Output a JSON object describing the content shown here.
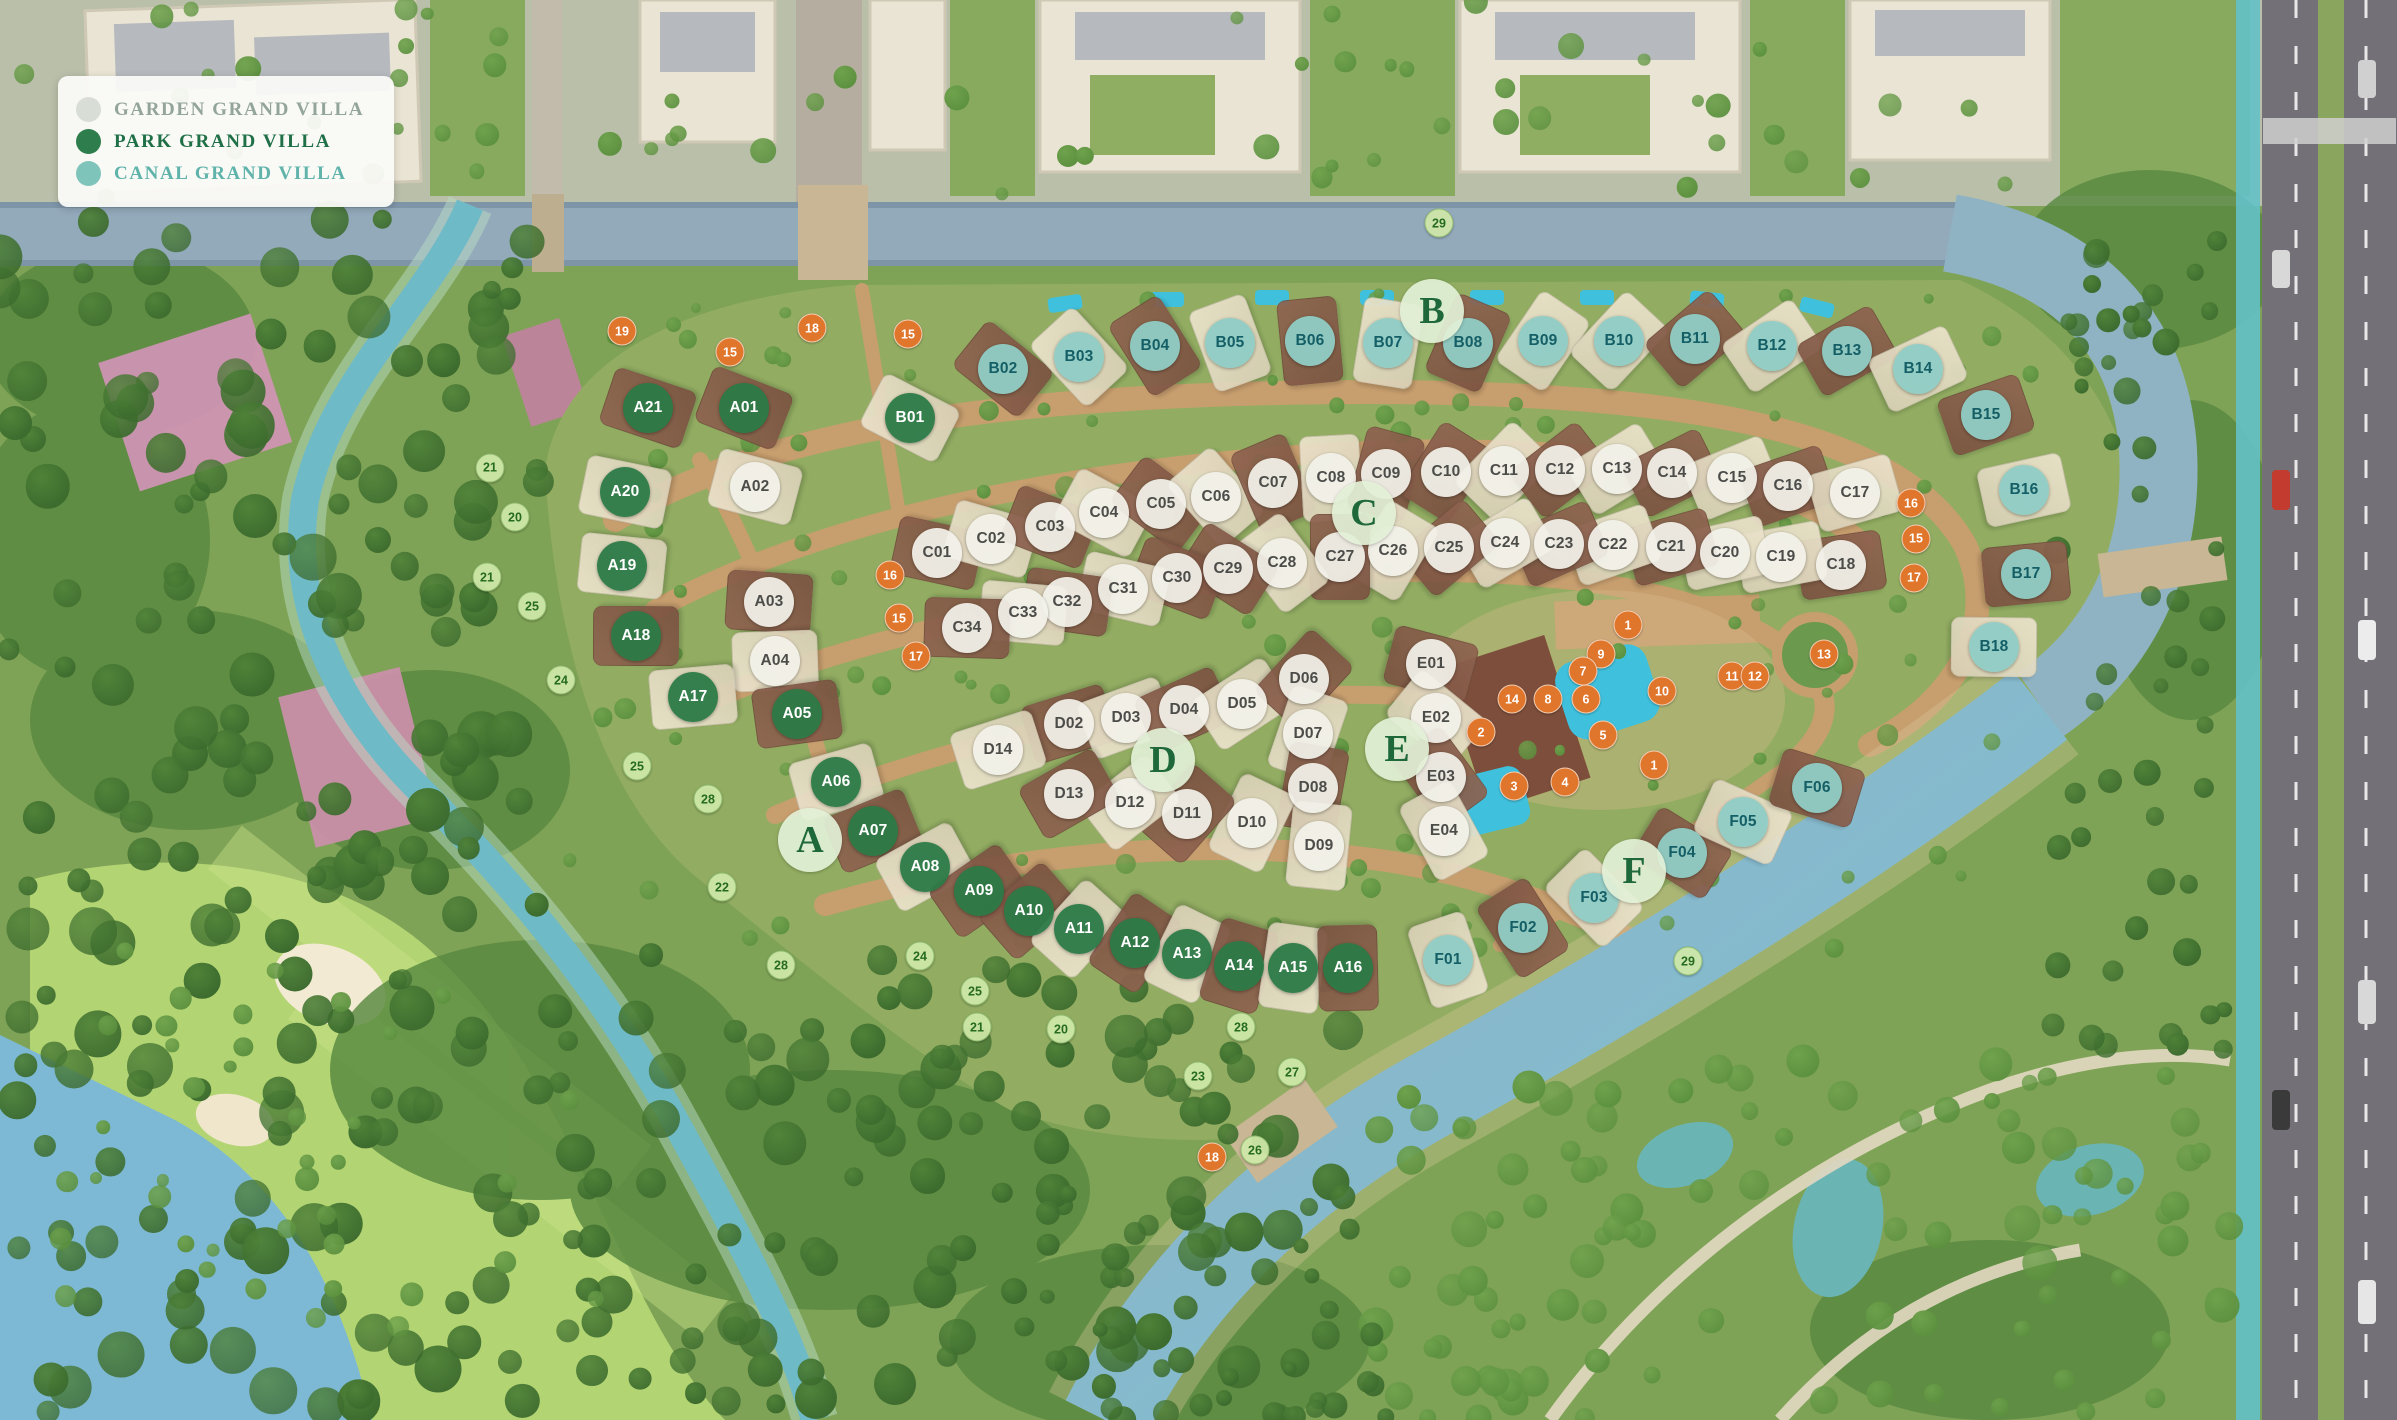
{
  "map_title": "Villa masterplan aerial map",
  "legend": {
    "items": [
      {
        "label": "GARDEN GRAND VILLA",
        "type": "garden",
        "dot_color": "#d8ddd6",
        "text_color": "#93a49b"
      },
      {
        "label": "PARK GRAND VILLA",
        "type": "park",
        "dot_color": "#2e7d4c",
        "text_color": "#1f6f47"
      },
      {
        "label": "CANAL GRAND VILLA",
        "type": "canal",
        "dot_color": "#7fc4bb",
        "text_color": "#5fb3aa"
      }
    ]
  },
  "colors": {
    "garden_badge": "#f2f1ea",
    "garden_text": "#4c4c49",
    "park_badge": "#2b7a47",
    "park_text": "#ffffff",
    "canal_badge": "#8fccc5",
    "canal_text": "#145e66",
    "green_marker": "#cfe8a8",
    "green_marker_text": "#266b1f",
    "orange_marker": "#e0762c",
    "orange_marker_text": "#ffffff",
    "water_top": "#93aabb",
    "water_canal": "#7cc0d8",
    "water_river": "#6fbac7",
    "golf": "#b3d473",
    "base_green": "#7fa356",
    "road_sand": "#c79e6e"
  },
  "sections": [
    {
      "id": "A",
      "x": 810,
      "y": 840
    },
    {
      "id": "B",
      "x": 1432,
      "y": 311
    },
    {
      "id": "C",
      "x": 1364,
      "y": 513
    },
    {
      "id": "D",
      "x": 1163,
      "y": 760
    },
    {
      "id": "E",
      "x": 1397,
      "y": 749
    },
    {
      "id": "F",
      "x": 1634,
      "y": 871
    }
  ],
  "villas": [
    {
      "id": "A01",
      "type": "park",
      "x": 744,
      "y": 408
    },
    {
      "id": "A02",
      "type": "garden",
      "x": 755,
      "y": 487
    },
    {
      "id": "A03",
      "type": "garden",
      "x": 769,
      "y": 602
    },
    {
      "id": "A04",
      "type": "garden",
      "x": 775,
      "y": 661
    },
    {
      "id": "A05",
      "type": "park",
      "x": 797,
      "y": 714
    },
    {
      "id": "A06",
      "type": "park",
      "x": 836,
      "y": 782
    },
    {
      "id": "A07",
      "type": "park",
      "x": 873,
      "y": 831
    },
    {
      "id": "A08",
      "type": "park",
      "x": 925,
      "y": 867
    },
    {
      "id": "A09",
      "type": "park",
      "x": 979,
      "y": 891
    },
    {
      "id": "A10",
      "type": "park",
      "x": 1029,
      "y": 911
    },
    {
      "id": "A11",
      "type": "park",
      "x": 1079,
      "y": 929
    },
    {
      "id": "A12",
      "type": "park",
      "x": 1135,
      "y": 943
    },
    {
      "id": "A13",
      "type": "park",
      "x": 1187,
      "y": 954
    },
    {
      "id": "A14",
      "type": "park",
      "x": 1239,
      "y": 966
    },
    {
      "id": "A15",
      "type": "park",
      "x": 1293,
      "y": 968
    },
    {
      "id": "A16",
      "type": "park",
      "x": 1348,
      "y": 968
    },
    {
      "id": "A17",
      "type": "park",
      "x": 693,
      "y": 697
    },
    {
      "id": "A18",
      "type": "park",
      "x": 636,
      "y": 636
    },
    {
      "id": "A19",
      "type": "park",
      "x": 622,
      "y": 566
    },
    {
      "id": "A20",
      "type": "park",
      "x": 625,
      "y": 492
    },
    {
      "id": "A21",
      "type": "park",
      "x": 648,
      "y": 408
    },
    {
      "id": "B01",
      "type": "park",
      "x": 910,
      "y": 418
    },
    {
      "id": "B02",
      "type": "canal",
      "x": 1003,
      "y": 369
    },
    {
      "id": "B03",
      "type": "canal",
      "x": 1079,
      "y": 357
    },
    {
      "id": "B04",
      "type": "canal",
      "x": 1155,
      "y": 346
    },
    {
      "id": "B05",
      "type": "canal",
      "x": 1230,
      "y": 343
    },
    {
      "id": "B06",
      "type": "canal",
      "x": 1310,
      "y": 341
    },
    {
      "id": "B07",
      "type": "canal",
      "x": 1388,
      "y": 343
    },
    {
      "id": "B08",
      "type": "canal",
      "x": 1468,
      "y": 343
    },
    {
      "id": "B09",
      "type": "canal",
      "x": 1543,
      "y": 341
    },
    {
      "id": "B10",
      "type": "canal",
      "x": 1619,
      "y": 341
    },
    {
      "id": "B11",
      "type": "canal",
      "x": 1695,
      "y": 339
    },
    {
      "id": "B12",
      "type": "canal",
      "x": 1772,
      "y": 346
    },
    {
      "id": "B13",
      "type": "canal",
      "x": 1847,
      "y": 351
    },
    {
      "id": "B14",
      "type": "canal",
      "x": 1918,
      "y": 369
    },
    {
      "id": "B15",
      "type": "canal",
      "x": 1986,
      "y": 415
    },
    {
      "id": "B16",
      "type": "canal",
      "x": 2024,
      "y": 490
    },
    {
      "id": "B17",
      "type": "canal",
      "x": 2026,
      "y": 574
    },
    {
      "id": "B18",
      "type": "canal",
      "x": 1994,
      "y": 647
    },
    {
      "id": "C01",
      "type": "garden",
      "x": 937,
      "y": 553
    },
    {
      "id": "C02",
      "type": "garden",
      "x": 991,
      "y": 539
    },
    {
      "id": "C03",
      "type": "garden",
      "x": 1050,
      "y": 527
    },
    {
      "id": "C04",
      "type": "garden",
      "x": 1104,
      "y": 513
    },
    {
      "id": "C05",
      "type": "garden",
      "x": 1161,
      "y": 504
    },
    {
      "id": "C06",
      "type": "garden",
      "x": 1216,
      "y": 497
    },
    {
      "id": "C07",
      "type": "garden",
      "x": 1273,
      "y": 483
    },
    {
      "id": "C08",
      "type": "garden",
      "x": 1331,
      "y": 478
    },
    {
      "id": "C09",
      "type": "garden",
      "x": 1386,
      "y": 474
    },
    {
      "id": "C10",
      "type": "garden",
      "x": 1446,
      "y": 472
    },
    {
      "id": "C11",
      "type": "garden",
      "x": 1504,
      "y": 471
    },
    {
      "id": "C12",
      "type": "garden",
      "x": 1560,
      "y": 470
    },
    {
      "id": "C13",
      "type": "garden",
      "x": 1617,
      "y": 469
    },
    {
      "id": "C14",
      "type": "garden",
      "x": 1672,
      "y": 473
    },
    {
      "id": "C15",
      "type": "garden",
      "x": 1732,
      "y": 478
    },
    {
      "id": "C16",
      "type": "garden",
      "x": 1788,
      "y": 486
    },
    {
      "id": "C17",
      "type": "garden",
      "x": 1855,
      "y": 493
    },
    {
      "id": "C18",
      "type": "garden",
      "x": 1841,
      "y": 565
    },
    {
      "id": "C19",
      "type": "garden",
      "x": 1781,
      "y": 557
    },
    {
      "id": "C20",
      "type": "garden",
      "x": 1725,
      "y": 553
    },
    {
      "id": "C21",
      "type": "garden",
      "x": 1671,
      "y": 547
    },
    {
      "id": "C22",
      "type": "garden",
      "x": 1613,
      "y": 545
    },
    {
      "id": "C23",
      "type": "garden",
      "x": 1559,
      "y": 544
    },
    {
      "id": "C24",
      "type": "garden",
      "x": 1505,
      "y": 543
    },
    {
      "id": "C25",
      "type": "garden",
      "x": 1449,
      "y": 548
    },
    {
      "id": "C26",
      "type": "garden",
      "x": 1393,
      "y": 551
    },
    {
      "id": "C27",
      "type": "garden",
      "x": 1340,
      "y": 557
    },
    {
      "id": "C28",
      "type": "garden",
      "x": 1282,
      "y": 563
    },
    {
      "id": "C29",
      "type": "garden",
      "x": 1228,
      "y": 569
    },
    {
      "id": "C30",
      "type": "garden",
      "x": 1177,
      "y": 578
    },
    {
      "id": "C31",
      "type": "garden",
      "x": 1123,
      "y": 589
    },
    {
      "id": "C32",
      "type": "garden",
      "x": 1067,
      "y": 602
    },
    {
      "id": "C33",
      "type": "garden",
      "x": 1023,
      "y": 613
    },
    {
      "id": "C34",
      "type": "garden",
      "x": 967,
      "y": 628
    },
    {
      "id": "D02",
      "type": "garden",
      "x": 1069,
      "y": 724
    },
    {
      "id": "D03",
      "type": "garden",
      "x": 1126,
      "y": 718
    },
    {
      "id": "D04",
      "type": "garden",
      "x": 1184,
      "y": 710
    },
    {
      "id": "D05",
      "type": "garden",
      "x": 1242,
      "y": 704
    },
    {
      "id": "D06",
      "type": "garden",
      "x": 1304,
      "y": 679
    },
    {
      "id": "D07",
      "type": "garden",
      "x": 1308,
      "y": 734
    },
    {
      "id": "D08",
      "type": "garden",
      "x": 1313,
      "y": 788
    },
    {
      "id": "D09",
      "type": "garden",
      "x": 1319,
      "y": 846
    },
    {
      "id": "D10",
      "type": "garden",
      "x": 1252,
      "y": 823
    },
    {
      "id": "D11",
      "type": "garden",
      "x": 1187,
      "y": 814
    },
    {
      "id": "D12",
      "type": "garden",
      "x": 1130,
      "y": 803
    },
    {
      "id": "D13",
      "type": "garden",
      "x": 1069,
      "y": 794
    },
    {
      "id": "D14",
      "type": "garden",
      "x": 998,
      "y": 750
    },
    {
      "id": "E01",
      "type": "garden",
      "x": 1431,
      "y": 664
    },
    {
      "id": "E02",
      "type": "garden",
      "x": 1436,
      "y": 718
    },
    {
      "id": "E03",
      "type": "garden",
      "x": 1441,
      "y": 777
    },
    {
      "id": "E04",
      "type": "garden",
      "x": 1444,
      "y": 831
    },
    {
      "id": "F01",
      "type": "canal",
      "x": 1448,
      "y": 960
    },
    {
      "id": "F02",
      "type": "canal",
      "x": 1523,
      "y": 928
    },
    {
      "id": "F03",
      "type": "canal",
      "x": 1594,
      "y": 898
    },
    {
      "id": "F04",
      "type": "canal",
      "x": 1682,
      "y": 853
    },
    {
      "id": "F05",
      "type": "canal",
      "x": 1743,
      "y": 822
    },
    {
      "id": "F06",
      "type": "canal",
      "x": 1817,
      "y": 788
    }
  ],
  "green_markers": [
    {
      "n": "29",
      "x": 1439,
      "y": 223
    },
    {
      "n": "21",
      "x": 490,
      "y": 468
    },
    {
      "n": "20",
      "x": 515,
      "y": 517
    },
    {
      "n": "21",
      "x": 487,
      "y": 577
    },
    {
      "n": "25",
      "x": 532,
      "y": 606
    },
    {
      "n": "24",
      "x": 561,
      "y": 680
    },
    {
      "n": "25",
      "x": 637,
      "y": 766
    },
    {
      "n": "28",
      "x": 708,
      "y": 799
    },
    {
      "n": "22",
      "x": 722,
      "y": 887
    },
    {
      "n": "28",
      "x": 781,
      "y": 965
    },
    {
      "n": "24",
      "x": 920,
      "y": 956
    },
    {
      "n": "25",
      "x": 975,
      "y": 991
    },
    {
      "n": "21",
      "x": 977,
      "y": 1027
    },
    {
      "n": "20",
      "x": 1061,
      "y": 1029
    },
    {
      "n": "28",
      "x": 1241,
      "y": 1027
    },
    {
      "n": "23",
      "x": 1198,
      "y": 1076
    },
    {
      "n": "27",
      "x": 1292,
      "y": 1072
    },
    {
      "n": "26",
      "x": 1255,
      "y": 1150
    },
    {
      "n": "29",
      "x": 1688,
      "y": 961
    }
  ],
  "orange_markers": [
    {
      "n": "19",
      "x": 622,
      "y": 331
    },
    {
      "n": "15",
      "x": 730,
      "y": 352
    },
    {
      "n": "18",
      "x": 812,
      "y": 328
    },
    {
      "n": "15",
      "x": 908,
      "y": 334
    },
    {
      "n": "16",
      "x": 890,
      "y": 575
    },
    {
      "n": "15",
      "x": 899,
      "y": 618
    },
    {
      "n": "17",
      "x": 916,
      "y": 656
    },
    {
      "n": "16",
      "x": 1911,
      "y": 503
    },
    {
      "n": "15",
      "x": 1916,
      "y": 539
    },
    {
      "n": "17",
      "x": 1914,
      "y": 578
    },
    {
      "n": "13",
      "x": 1824,
      "y": 654
    },
    {
      "n": "11",
      "x": 1732,
      "y": 676
    },
    {
      "n": "12",
      "x": 1755,
      "y": 676
    },
    {
      "n": "10",
      "x": 1662,
      "y": 691
    },
    {
      "n": "9",
      "x": 1601,
      "y": 654
    },
    {
      "n": "7",
      "x": 1583,
      "y": 671
    },
    {
      "n": "8",
      "x": 1548,
      "y": 699
    },
    {
      "n": "6",
      "x": 1586,
      "y": 699
    },
    {
      "n": "14",
      "x": 1512,
      "y": 699
    },
    {
      "n": "1",
      "x": 1628,
      "y": 625
    },
    {
      "n": "2",
      "x": 1481,
      "y": 732
    },
    {
      "n": "5",
      "x": 1603,
      "y": 735
    },
    {
      "n": "1",
      "x": 1654,
      "y": 765
    },
    {
      "n": "3",
      "x": 1514,
      "y": 786
    },
    {
      "n": "4",
      "x": 1565,
      "y": 782
    },
    {
      "n": "18",
      "x": 1212,
      "y": 1157
    }
  ]
}
